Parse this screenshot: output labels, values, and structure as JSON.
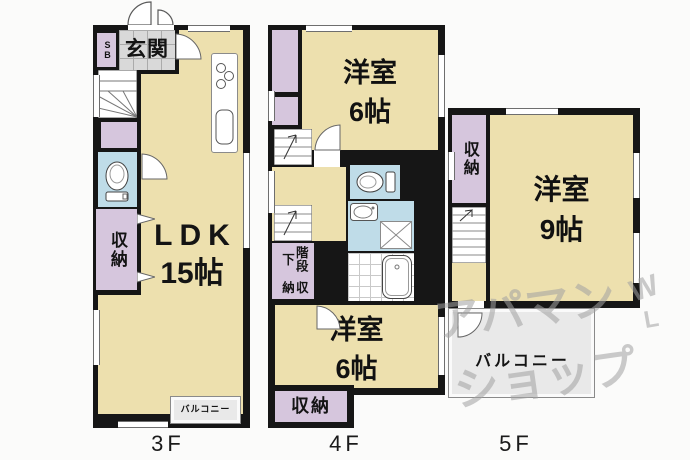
{
  "palette": {
    "wall": "#161616",
    "room_floor": "#EDE0AE",
    "closet": "#D6C6DD",
    "wet_area": "#BFDCE8",
    "entry_tile": "#D9D9D9",
    "balcony_floor": "#E9E9E9",
    "watermark_gray": "#A2A2A2",
    "background": "#FBFBFA"
  },
  "floors": {
    "f3": {
      "floor_label": "3F",
      "genkan": "玄関",
      "shoe_box": "SB",
      "storage": "収納",
      "ldk_name": "LDK",
      "ldk_size": "15帖",
      "balcony": "バルコニー"
    },
    "f4": {
      "floor_label": "4F",
      "room_top_name": "洋室",
      "room_top_size": "6帖",
      "stairs_storage_line1": "階段下",
      "stairs_storage_line2": "収納",
      "room_bottom_name": "洋室",
      "room_bottom_size": "6帖",
      "storage": "収納"
    },
    "f5": {
      "floor_label": "5F",
      "storage": "収納",
      "room_name": "洋室",
      "room_size": "9帖",
      "balcony": "バルコニー"
    }
  },
  "watermark": {
    "line1": "アパマン",
    "line2": "ショップ",
    "mark_top": "W",
    "mark_bottom": "L"
  }
}
